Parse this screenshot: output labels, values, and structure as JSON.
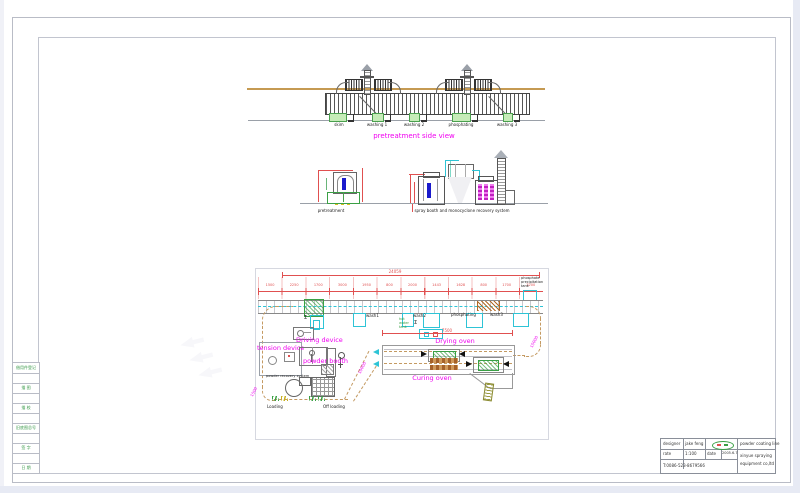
{
  "colors": {
    "magenta": "#F000F0",
    "red": "#E05050",
    "green": "#3AA045",
    "cyan": "#2EC4D6",
    "tan": "#C49A62",
    "blue": "#1A1ACC",
    "brown": "#A5622A"
  },
  "side_view": {
    "title": "pretreatment side view",
    "stations": [
      "skim",
      "washing 1",
      "washing 2",
      "phosphating",
      "washing 3"
    ]
  },
  "elevations": {
    "left_label": "pretreatment",
    "right_label": "spray booth and monocyclone recovery system"
  },
  "plan": {
    "note": "phosphate precipitation tank",
    "driving": "Driving device",
    "tension": "tension device",
    "powder_booth": "powder booth",
    "recovery": "powder recovery system",
    "loading": "Loading",
    "off_loading": "Off loading",
    "drying": "Drying oven",
    "curing": "Curing oven",
    "hot_water": "hot water tank",
    "sigma": "Σ",
    "stations": [
      "wash1",
      "wash2",
      "phosphating",
      "wash3"
    ],
    "dims": {
      "overall": "24059",
      "oven": "7500",
      "right": "15000",
      "exit": "10000",
      "left": "1500",
      "segments": [
        "1500",
        "2250",
        "1700",
        "3000",
        "1950",
        "800",
        "2000",
        "1443",
        "1628",
        "800",
        "1700",
        "2200"
      ]
    }
  },
  "title_block": {
    "designer_label": "designer",
    "designer": "jake feng",
    "rate_label": "rate",
    "rate": "1:100",
    "date_label": "date",
    "date": "2005.6.7",
    "phone": "T:0086-523-8679566",
    "project": "powder coating line",
    "company_line1": "xinyue spraying",
    "company_line2": "equipment co,ltd"
  },
  "rev_strip": {
    "cells": [
      "借用件登记",
      "描 图",
      "描 校",
      "旧底图总号",
      "签 字",
      "日 期"
    ]
  }
}
